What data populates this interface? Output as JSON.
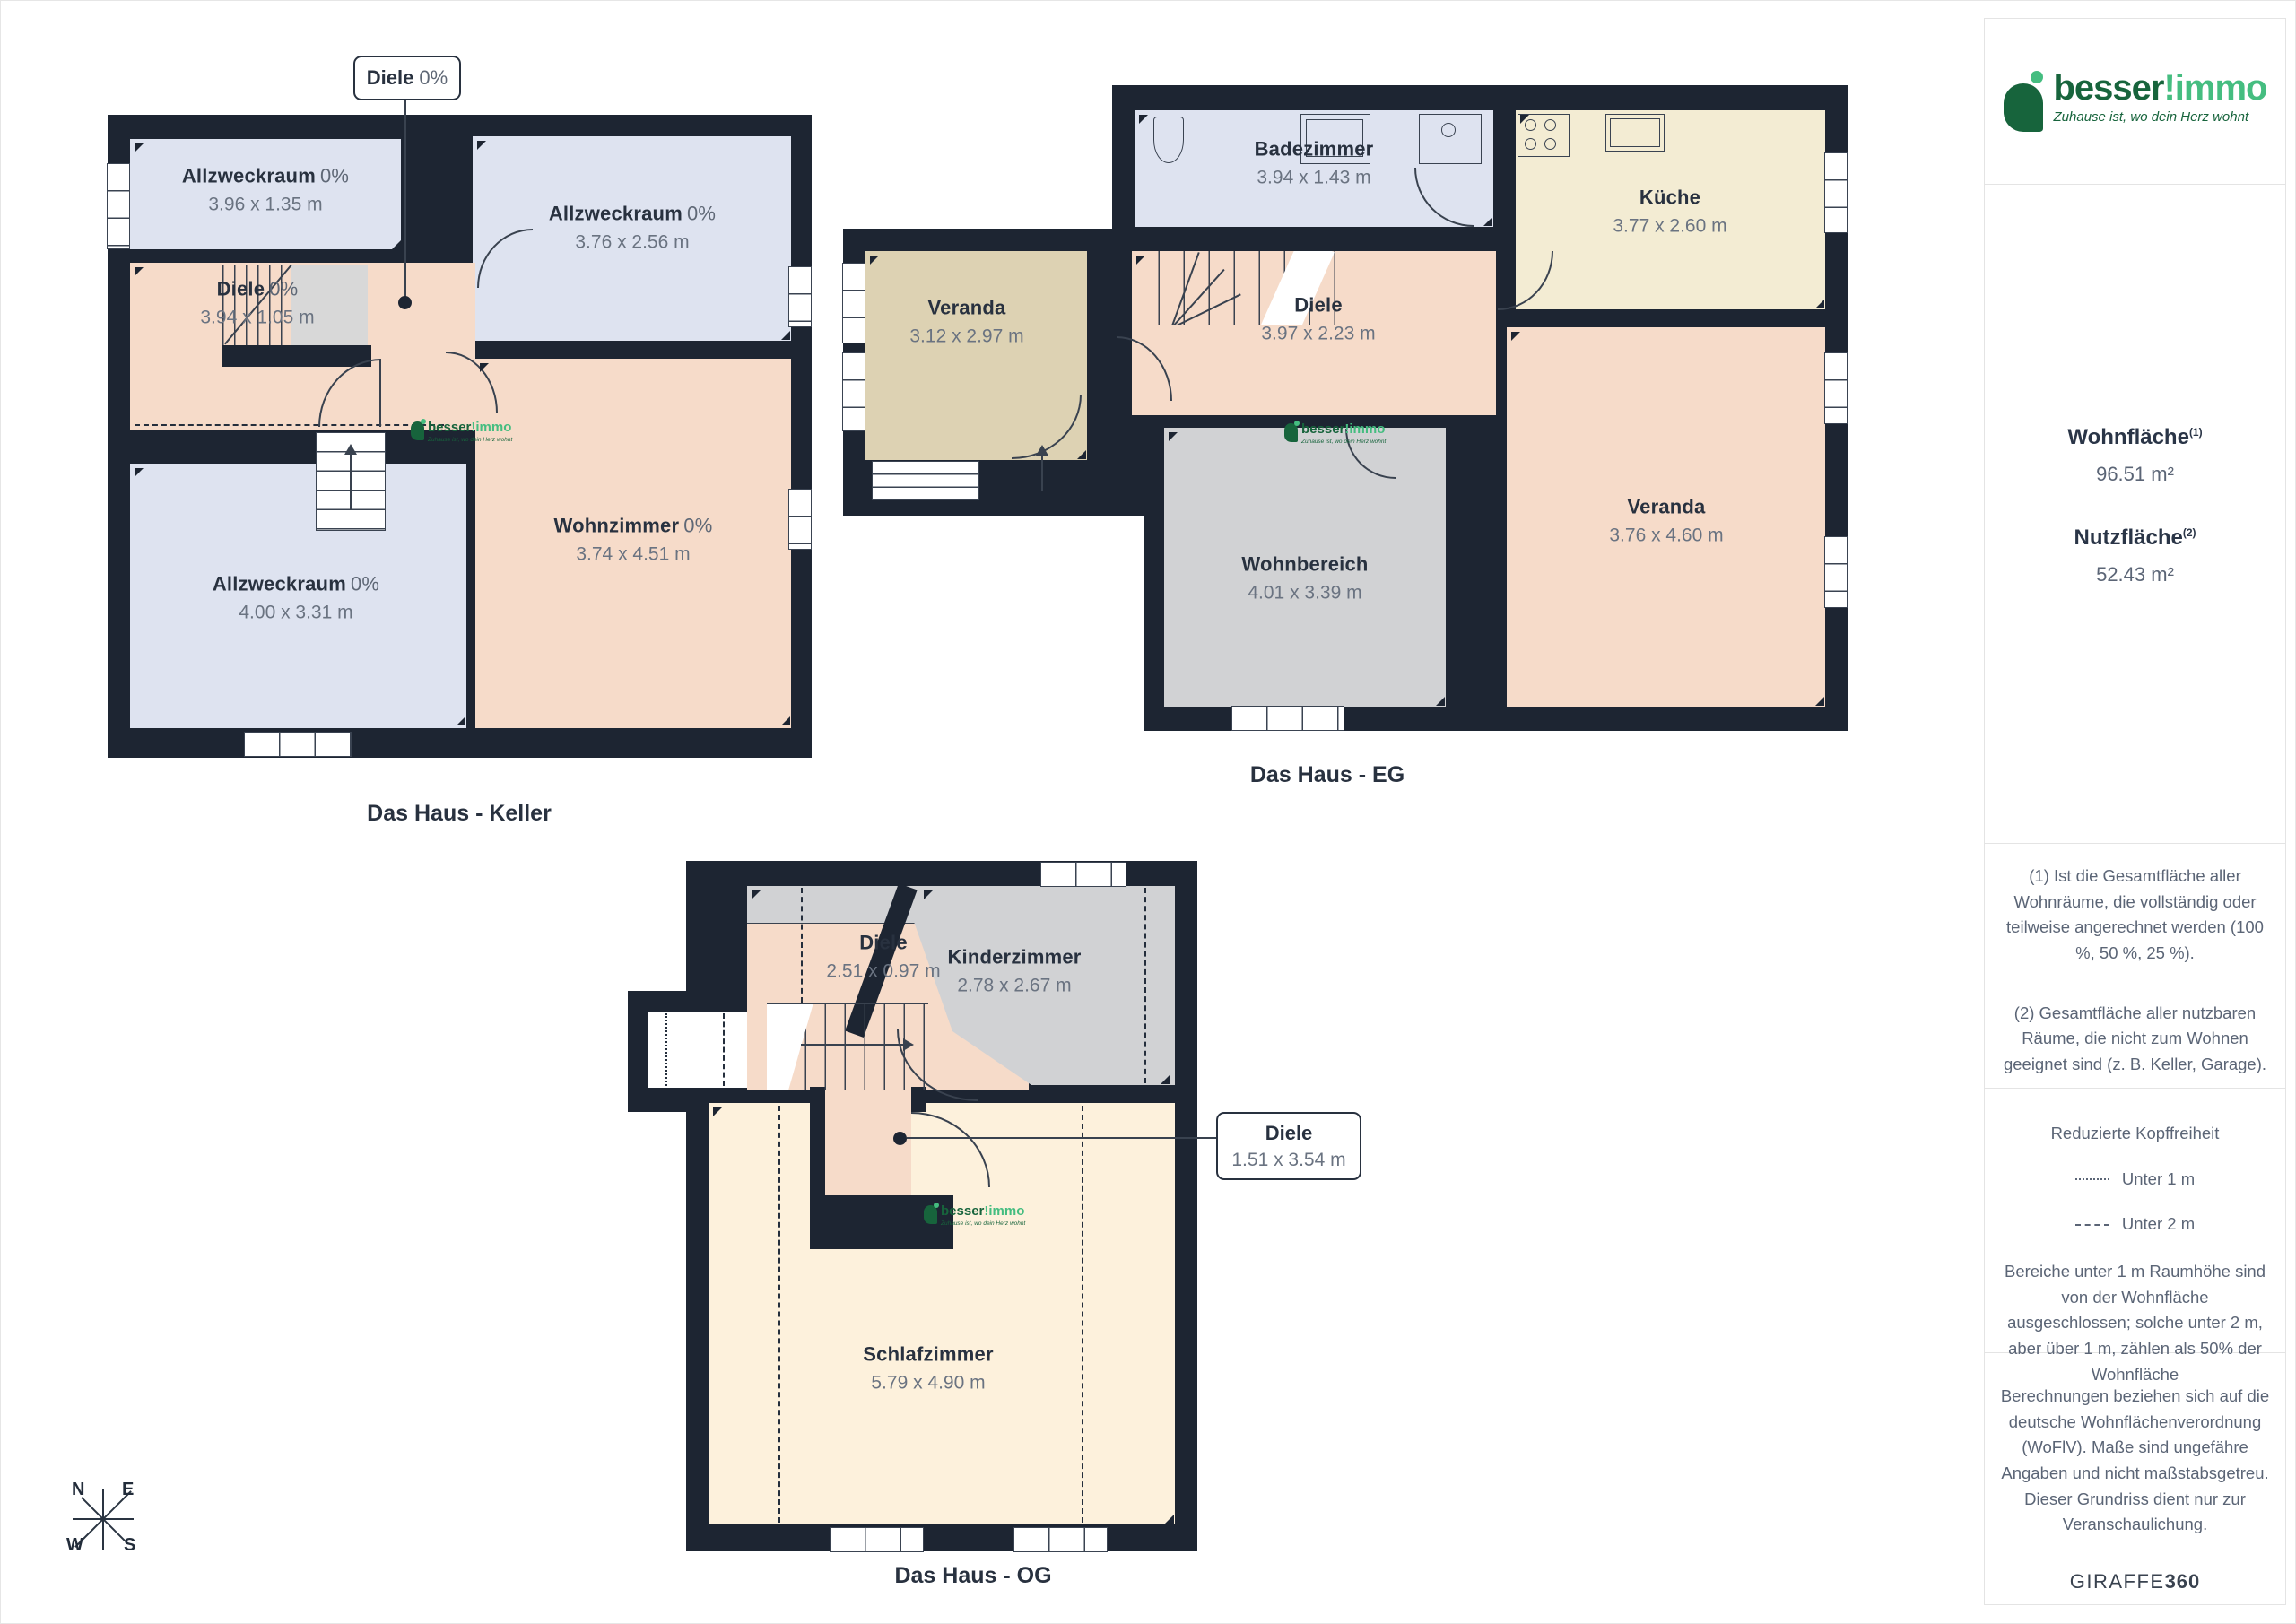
{
  "brand": {
    "word_dark": "besser",
    "word_light": "!immo",
    "tagline": "Zuhause ist, wo dein Herz wohnt",
    "color_dark_green": "#17643c",
    "color_light_green": "#45bd80"
  },
  "plans": {
    "keller": {
      "title": "Das Haus - Keller",
      "callout": {
        "name": "Diele",
        "pct": "0%"
      },
      "rooms": {
        "allzweckraum_top": {
          "name": "Allzweckraum",
          "pct": "0%",
          "dims": "3.96 x 1.35 m"
        },
        "allzweckraum_right": {
          "name": "Allzweckraum",
          "pct": "0%",
          "dims": "3.76 x 2.56 m"
        },
        "diele": {
          "name": "Diele",
          "pct": "0%",
          "dims": "3.94 x 1.05 m"
        },
        "wohnzimmer": {
          "name": "Wohnzimmer",
          "pct": "0%",
          "dims": "3.74 x 4.51 m"
        },
        "allzweckraum_bottom": {
          "name": "Allzweckraum",
          "pct": "0%",
          "dims": "4.00 x 3.31 m"
        }
      }
    },
    "eg": {
      "title": "Das Haus - EG",
      "rooms": {
        "badezimmer": {
          "name": "Badezimmer",
          "dims": "3.94 x 1.43 m"
        },
        "kueche": {
          "name": "Küche",
          "dims": "3.77 x 2.60 m"
        },
        "veranda_links": {
          "name": "Veranda",
          "dims": "3.12 x 2.97 m"
        },
        "diele": {
          "name": "Diele",
          "dims": "3.97 x 2.23 m"
        },
        "wohnbereich": {
          "name": "Wohnbereich",
          "dims": "4.01 x 3.39 m"
        },
        "veranda_rechts": {
          "name": "Veranda",
          "dims": "3.76 x 4.60 m"
        }
      }
    },
    "og": {
      "title": "Das Haus - OG",
      "callout": {
        "name": "Diele",
        "dims": "1.51 x 3.54 m"
      },
      "rooms": {
        "diele": {
          "name": "Diele",
          "dims": "2.51 x 0.97 m"
        },
        "kinderzimmer": {
          "name": "Kinderzimmer",
          "dims": "2.78 x 2.67 m"
        },
        "schlafzimmer": {
          "name": "Schlafzimmer",
          "dims": "5.79 x 4.90 m"
        }
      }
    }
  },
  "compass": {
    "n": "N",
    "e": "E",
    "s": "S",
    "w": "W"
  },
  "sidebar": {
    "wohnflaeche_label": "Wohnfläche",
    "wohnflaeche_sup": "(1)",
    "wohnflaeche_value": "96.51 m²",
    "nutzflaeche_label": "Nutzfläche",
    "nutzflaeche_sup": "(2)",
    "nutzflaeche_value": "52.43 m²",
    "footnote_1": "(1) Ist die Gesamtfläche aller Wohnräume, die vollständig oder teilweise angerechnet werden (100 %, 50 %, 25 %).",
    "footnote_2": "(2) Gesamtfläche aller nutzbaren Räume, die nicht zum Wohnen geeignet sind (z. B. Keller, Garage).",
    "kopffreiheit_title": "Reduzierte Kopffreiheit",
    "legend_unter_1m": "Unter 1 m",
    "legend_unter_2m": "Unter 2 m",
    "kopffreiheit_text": "Bereiche unter 1 m Raumhöhe sind von der Wohnfläche ausgeschlossen; solche unter 2 m, aber über 1 m, zählen als 50% der Wohnfläche",
    "disclaimer": "Berechnungen beziehen sich auf die deutsche Wohnflächenverordnung (WoFlV). Maße sind ungefähre Angaben und nicht maßstabsgetreu. Dieser Grundriss dient nur zur Veranschaulichung.",
    "brand_footer_regular": "GIRAFFE",
    "brand_footer_bold": "360"
  },
  "colors": {
    "wall": "#1d2532",
    "room_blue": "#dee3f0",
    "room_pink": "#f6dbc9",
    "room_tan": "#ddd2b3",
    "room_cream": "#f3ecd3",
    "room_cream_light": "#fdf1dc",
    "room_gray": "#d1d2d4",
    "stroke": "#3a4351",
    "label_dark": "#28313f",
    "label_gray": "#6a7381"
  }
}
